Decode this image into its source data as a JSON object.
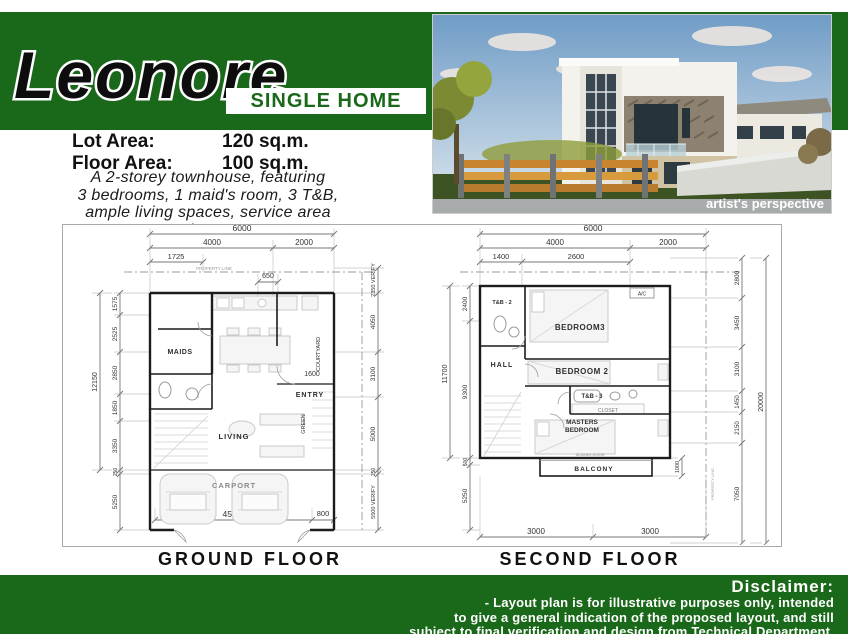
{
  "colors": {
    "brand_green": "#1a691a",
    "text": "#111111",
    "plan_line": "#222222",
    "dim_line": "#777777"
  },
  "header": {
    "script_title": "Leonore",
    "subtitle": "SINGLE HOME"
  },
  "photo": {
    "caption": "artist's perspective"
  },
  "specs": {
    "lot_area_label": "Lot Area:",
    "lot_area_value": "120 sq.m.",
    "floor_area_label": "Floor Area:",
    "floor_area_value": "100 sq.m.",
    "description_lines": [
      "A 2-storey townhouse, featuring",
      "3 bedrooms, 1 maid's room, 3 T&B,",
      "ample living spaces, service area",
      "and carport"
    ]
  },
  "ground_floor": {
    "title": "GROUND FLOOR",
    "property_line_label": "PROPERTY LINE",
    "rooms": {
      "maids": "MAIDS",
      "living": "LIVING",
      "entry": "ENTRY",
      "carport": "CARPORT",
      "courtyard": "COURTYARD",
      "green": "GREEN"
    },
    "dims": {
      "top_overall": "6000",
      "top_left": "4000",
      "top_right": "2000",
      "top_inner": "1725",
      "kitchen": "650",
      "entry_width": "1600",
      "left_overall": "12150",
      "left_segments": [
        "1575",
        "2525",
        "2850",
        "1850",
        "3350",
        "250",
        "5250"
      ],
      "right_segments": [
        "2350 VERIFY",
        "4050",
        "3100",
        "5000",
        "250",
        "5500 VERIFY"
      ],
      "bottom_left": "4582",
      "bottom_right": "800"
    }
  },
  "second_floor": {
    "title": "SECOND FLOOR",
    "property_line_label": "PROPERTY LINE",
    "rooms": {
      "tb2": "T&B - 2",
      "bedroom3": "BEDROOM3",
      "ac": "A/C",
      "hall": "HALL",
      "bedroom2": "BEDROOM 2",
      "tb3": "T&B - 3",
      "closet": "CLOSET",
      "masters_line1": "MASTERS",
      "masters_line2": "BEDROOM",
      "balcony": "BALCONY",
      "sliding_door": "SLIDING DOOR"
    },
    "dims": {
      "top_overall": "6000",
      "top_left": "4000",
      "top_right": "2000",
      "top_inner_left": "1400",
      "top_inner_right": "2600",
      "left_overall": "11700",
      "left_segments": [
        "2400",
        "9300",
        "500",
        "5250"
      ],
      "right_overall": "20000",
      "right_segments": [
        "2800",
        "3450",
        "3100",
        "1450",
        "2150",
        "7050"
      ],
      "balcony_right": "1000",
      "bottom_left": "3000",
      "bottom_right": "3000"
    }
  },
  "disclaimer": {
    "heading": "Disclaimer:",
    "lines": [
      "- Layout plan is for illustrative purposes only, intended",
      "to give a general indication of the proposed layout, and still",
      "subject to final verification and design from Technical Department."
    ]
  }
}
